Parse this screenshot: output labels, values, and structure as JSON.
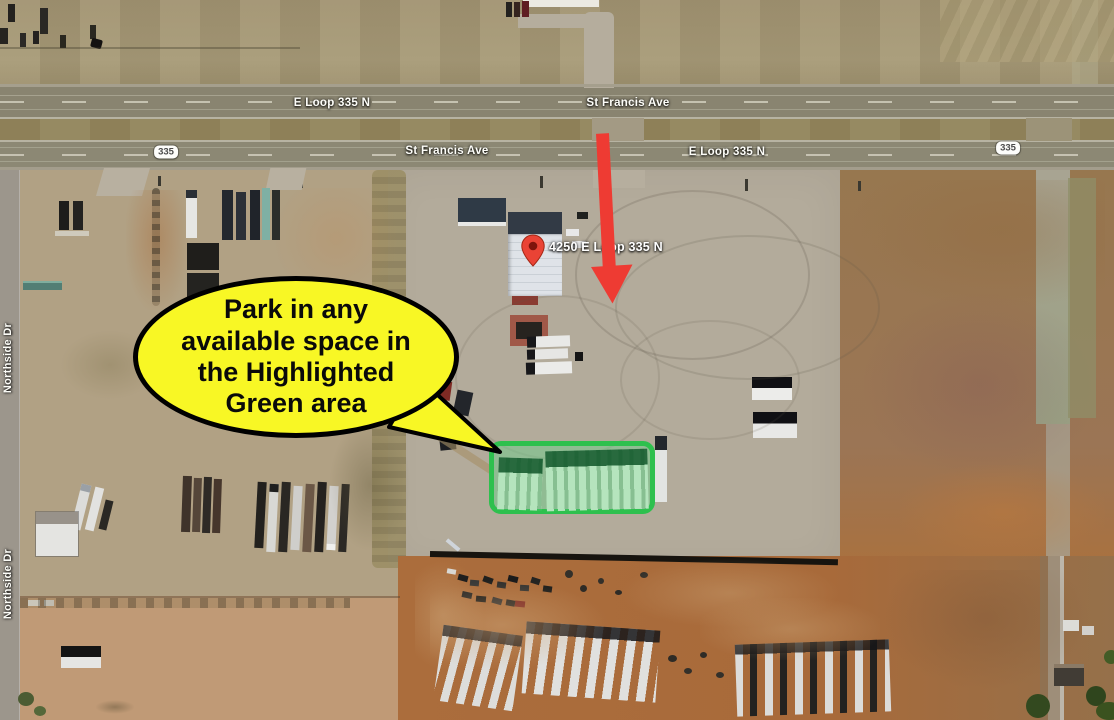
{
  "roads": {
    "e_loop_top": "E Loop 335 N",
    "st_francis_top": "St Francis Ave",
    "st_francis_bottom": "St Francis Ave",
    "e_loop_bottom": "E Loop 335 N",
    "route_shield": "335",
    "northside_upper": "Northside Dr",
    "northside_lower": "Northside Dr"
  },
  "pin": {
    "label": "4250 E Loop 335 N"
  },
  "bubble": {
    "lines": [
      "Park in any",
      "available space in",
      "the Highlighted",
      "Green area"
    ]
  },
  "colors": {
    "bubble_yellow": "#f8f725",
    "arrow_red": "#ee3b33",
    "pin_red": "#ea4335",
    "green_border": "#2ec04e",
    "green_fill": "rgba(110,205,140,0.5)"
  }
}
